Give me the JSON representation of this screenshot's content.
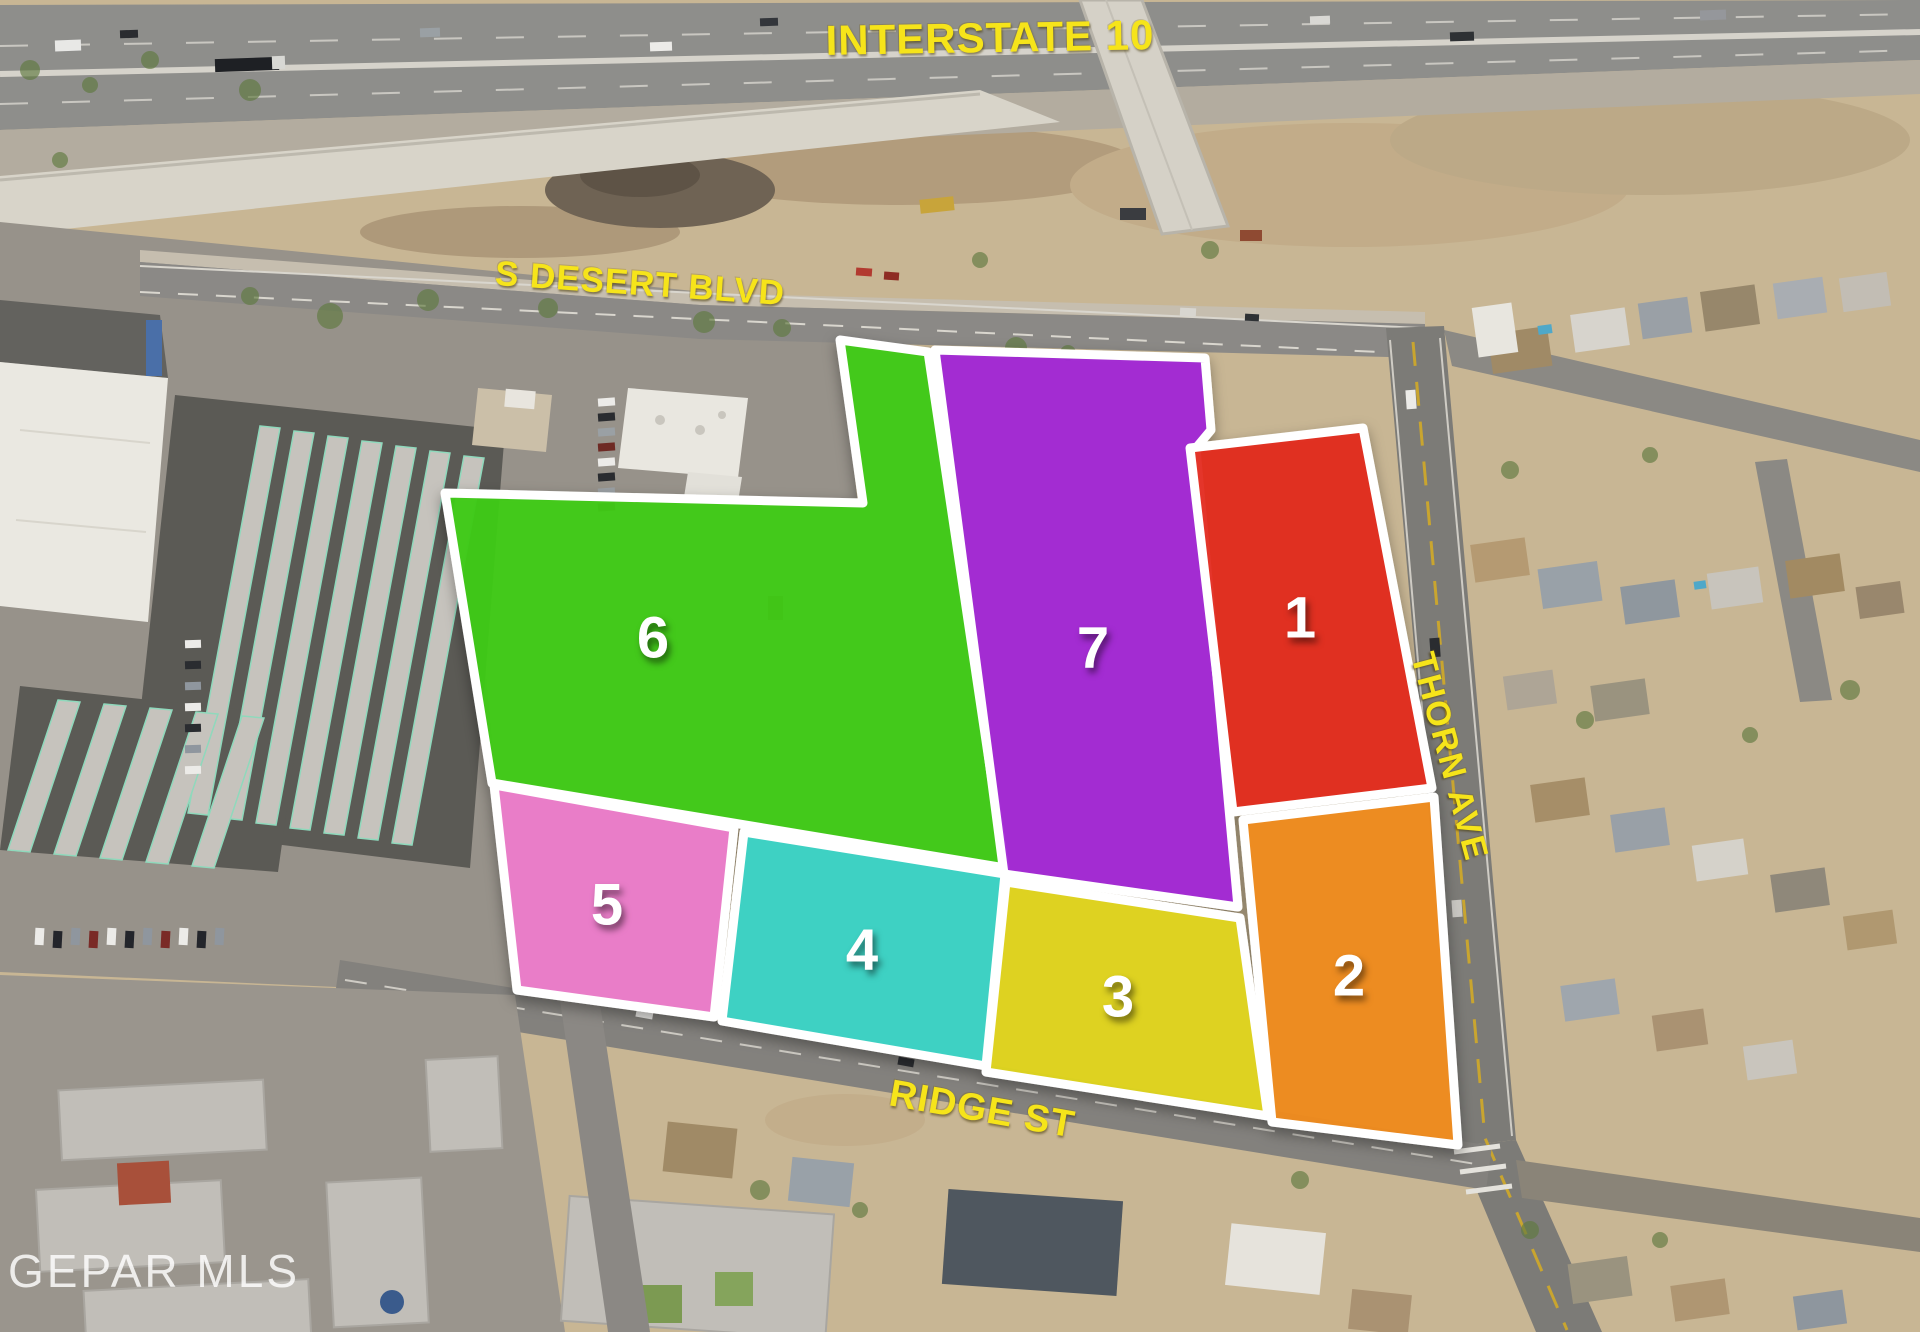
{
  "map": {
    "watermark": "GEPAR MLS",
    "streets": {
      "interstate": "INTERSTATE 10",
      "desert_blvd": "S DESERT BLVD",
      "thorn_ave": "THORN AVE",
      "ridge_st": "RIDGE ST"
    },
    "label_color": "#F6E41A",
    "parcel_border_color": "#FFFFFF",
    "parcels": [
      {
        "number": "6",
        "color": "#3FCB17",
        "points": [
          [
            840,
            340
          ],
          [
            928,
            352
          ],
          [
            1005,
            868
          ],
          [
            492,
            783
          ],
          [
            445,
            493
          ],
          [
            863,
            503
          ]
        ],
        "label_x": 653,
        "label_y": 638
      },
      {
        "number": "7",
        "color": "#A228D6",
        "points": [
          [
            935,
            350
          ],
          [
            1205,
            358
          ],
          [
            1211,
            430
          ],
          [
            1196,
            448
          ],
          [
            1238,
            907
          ],
          [
            1004,
            874
          ]
        ],
        "label_x": 1093,
        "label_y": 648
      },
      {
        "number": "1",
        "color": "#E32A1E",
        "points": [
          [
            1190,
            448
          ],
          [
            1363,
            428
          ],
          [
            1432,
            788
          ],
          [
            1233,
            812
          ]
        ],
        "label_x": 1300,
        "label_y": 618
      },
      {
        "number": "2",
        "color": "#F08B1E",
        "points": [
          [
            1243,
            820
          ],
          [
            1434,
            797
          ],
          [
            1458,
            1145
          ],
          [
            1272,
            1122
          ]
        ],
        "label_x": 1349,
        "label_y": 976
      },
      {
        "number": "3",
        "color": "#E0D51F",
        "points": [
          [
            1006,
            882
          ],
          [
            1240,
            918
          ],
          [
            1268,
            1116
          ],
          [
            986,
            1072
          ]
        ],
        "label_x": 1118,
        "label_y": 997
      },
      {
        "number": "4",
        "color": "#38D4C6",
        "points": [
          [
            744,
            832
          ],
          [
            1005,
            874
          ],
          [
            986,
            1066
          ],
          [
            722,
            1021
          ]
        ],
        "label_x": 862,
        "label_y": 950
      },
      {
        "number": "5",
        "color": "#EC7CCB",
        "points": [
          [
            494,
            785
          ],
          [
            734,
            828
          ],
          [
            714,
            1017
          ],
          [
            517,
            990
          ]
        ],
        "label_x": 607,
        "label_y": 905
      }
    ]
  }
}
